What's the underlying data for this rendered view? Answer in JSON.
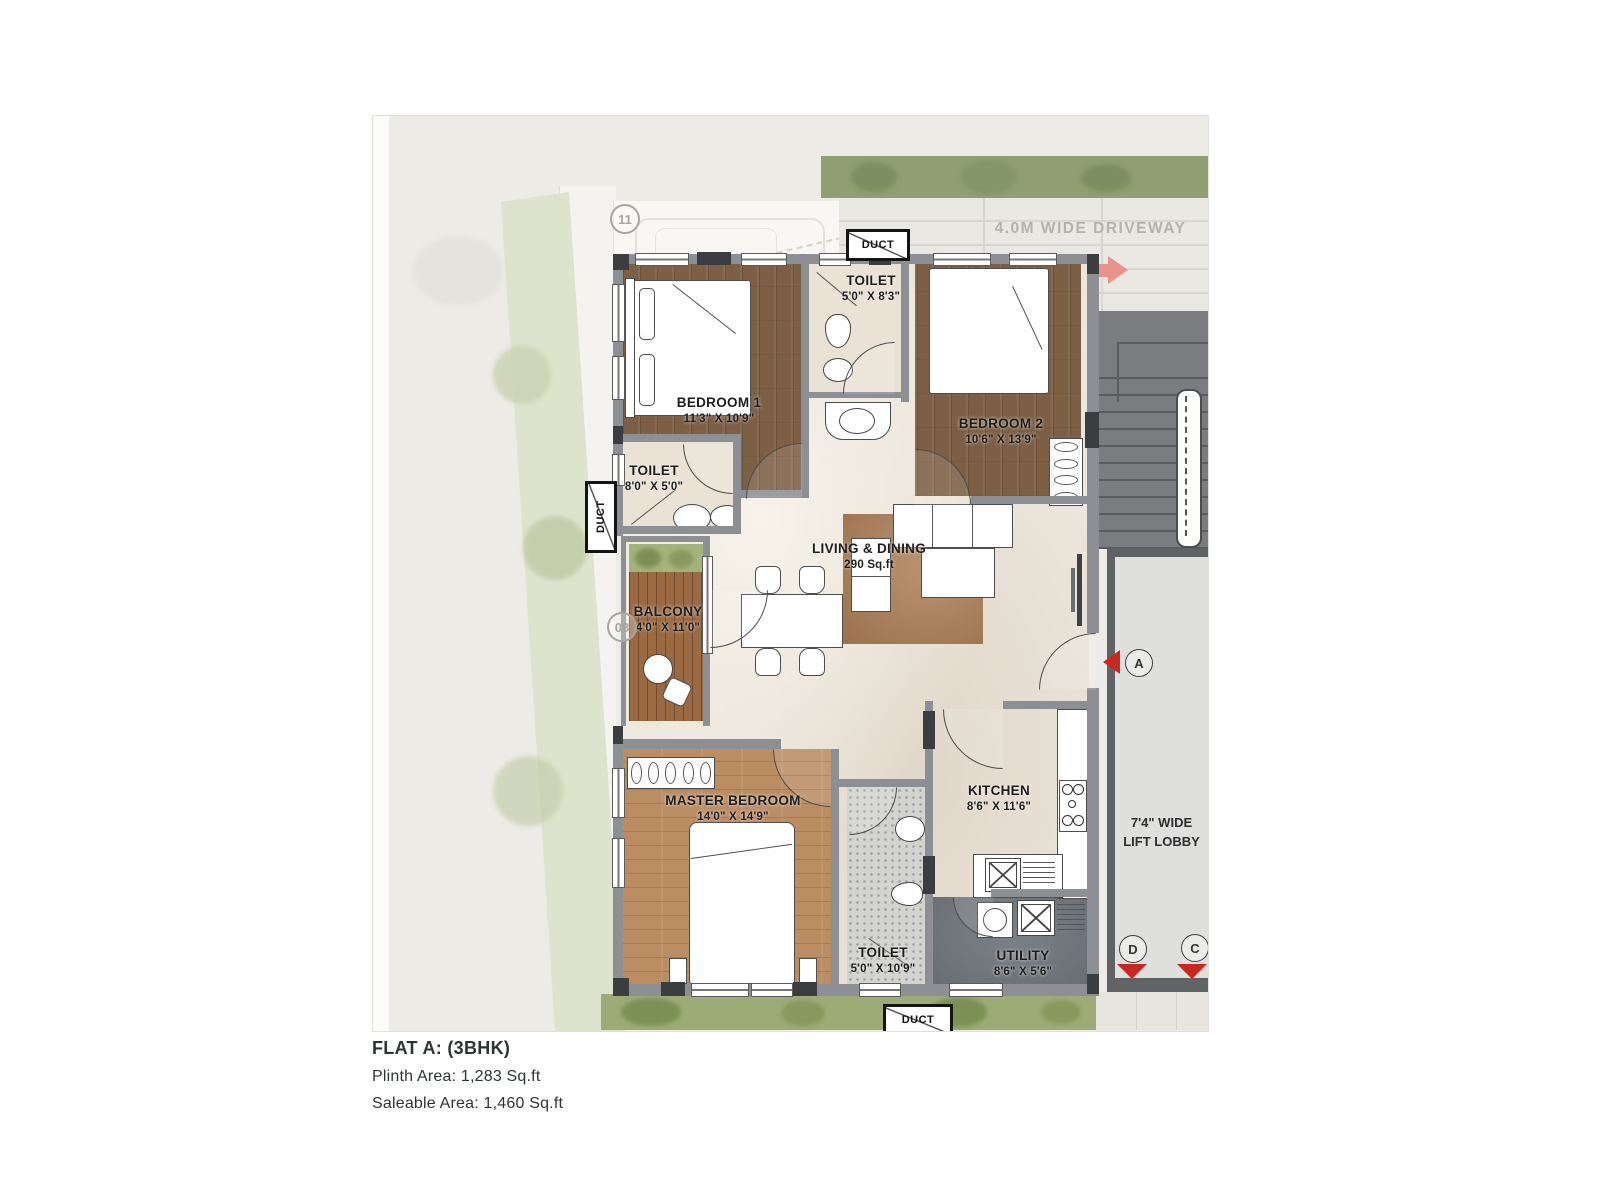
{
  "caption": {
    "title": "FLAT A: (3BHK)",
    "plinth": "Plinth Area: 1,283 Sq.ft",
    "saleable": "Saleable Area: 1,460 Sq.ft"
  },
  "site": {
    "driveway_label": "4.0M WIDE DRIVEWAY",
    "parking_marker": "11",
    "balcony_marker": "08",
    "entry_marker": "A",
    "marker_d": "D",
    "marker_c": "C",
    "duct_top": "DUCT",
    "duct_left": "DUCT",
    "duct_bottom": "DUCT"
  },
  "rooms": {
    "bedroom1": {
      "name": "BEDROOM 1",
      "dims": "11'3\" X 10'9\""
    },
    "toilet_common": {
      "name": "TOILET",
      "dims": "5'0\" X 8'3\""
    },
    "bedroom2": {
      "name": "BEDROOM 2",
      "dims": "10'6\" X 13'9\""
    },
    "toilet_bed1": {
      "name": "TOILET",
      "dims": "8'0\" X 5'0\""
    },
    "balcony": {
      "name": "BALCONY",
      "dims": "4'0\" X 11'0\""
    },
    "living": {
      "name": "LIVING & DINING",
      "dims": "290 Sq.ft"
    },
    "master_bedroom": {
      "name": "MASTER BEDROOM",
      "dims": "14'0\" X 14'9\""
    },
    "toilet_master": {
      "name": "TOILET",
      "dims": "5'0\" X 10'9\""
    },
    "kitchen": {
      "name": "KITCHEN",
      "dims": "8'6\" X 11'6\""
    },
    "utility": {
      "name": "UTILITY",
      "dims": "8'6\" X 5'6\""
    },
    "lift_lobby": {
      "line1": "7'4\" WIDE",
      "line2": "LIFT LOBBY"
    }
  },
  "colors": {
    "accent_red": "#c9271f",
    "arrow_pink": "#e8938c",
    "wall_gray": "#8c9094",
    "wood_dark": "#7d5f45",
    "wood_light": "#bb8d63",
    "lawn_green": "#9dac77"
  }
}
